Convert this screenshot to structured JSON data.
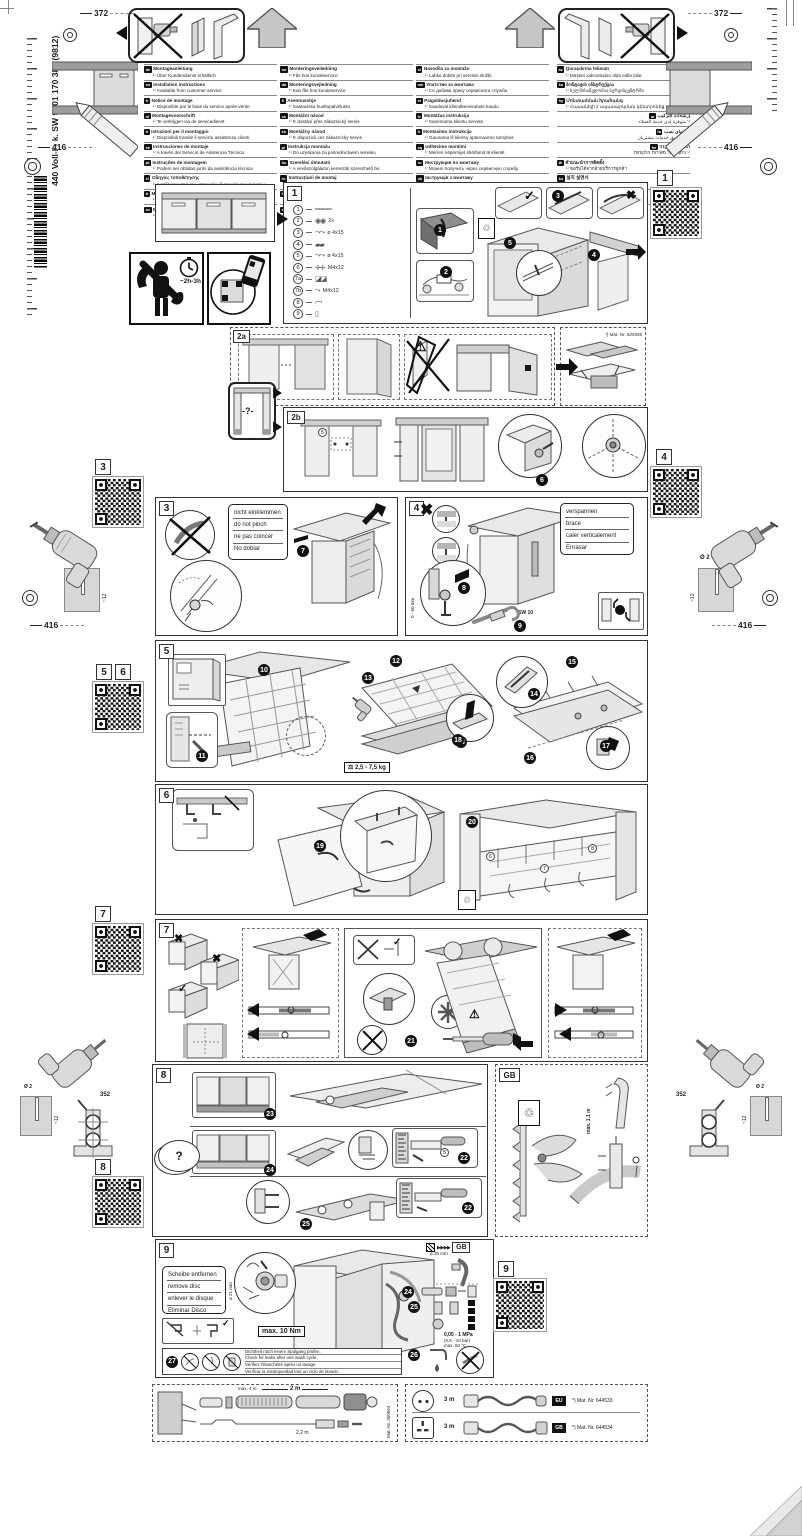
{
  "pg": {
    "vertical_code": "440 Voll-I - k. SW  9001 170 388 (9812)",
    "d372": "372",
    "d416": "416",
    "d352": "352",
    "drill_dia": "Ø 2",
    "drill_depth": "~12",
    "time_badge": "~2h-3h"
  },
  "ic": {
    "check": "✓",
    "cross": "✖",
    "warn": "⚠",
    "question": "?",
    "fast": "▶▶▶▶",
    "bin": "♲",
    "rotate": "↻"
  },
  "lang": {
    "col1": [
      {
        "code": "de",
        "title": "Montageanleitung",
        "note": "¹⁾ Über Kundendienst erhältlich"
      },
      {
        "code": "en",
        "title": "Installation instructions",
        "note": "¹⁾ Available from customer service"
      },
      {
        "code": "fr",
        "title": "Notice de montage",
        "note": "¹⁾ Disponible par le biais du service après-vente"
      },
      {
        "code": "nl",
        "title": "Montagevoorschrift",
        "note": "¹⁾ Te verkrijgen via de servicedienst"
      },
      {
        "code": "it",
        "title": "Istruzioni per il montaggio",
        "note": "¹⁾ Disponibili tramite il servizio assistenza clienti"
      },
      {
        "code": "es",
        "title": "Instrucciones de montaje",
        "note": "¹⁾ A través del Servicio de Asistencia Técnica"
      },
      {
        "code": "pt",
        "title": "Instruções de montagem",
        "note": "¹⁾ Podem ser obtidas junto da assistência técnica"
      },
      {
        "code": "el",
        "title": "Οδηγίες τοποθέτησης",
        "note": "¹⁾ Διατίθενται από την υπηρεσία εξυπηρέτησης πελατών"
      },
      {
        "code": "tr",
        "title": "Montaj kılavuzu",
        "note": "¹⁾ Yetkili servisten temin edilebilir"
      },
      {
        "code": "sv",
        "title": "Monteringsanvisning",
        "note": "¹⁾ Kan beställas via kundtjänst"
      }
    ],
    "col2": [
      {
        "code": "no",
        "title": "Monteringsveiledning",
        "note": "¹⁾ Fås hos kundeservice"
      },
      {
        "code": "da",
        "title": "Monteringsvejledning",
        "note": "¹⁾ Kan fås hos kundeservice"
      },
      {
        "code": "fi",
        "title": "Asennusohje",
        "note": "¹⁾ Saatavissa huoltopalvelusta"
      },
      {
        "code": "cs",
        "title": "Montážní návod",
        "note": "¹⁾ K dostání přes zákaznický servis"
      },
      {
        "code": "sk",
        "title": "Montážny návod",
        "note": "¹⁾ K dispozícii cez zákaznícky servis"
      },
      {
        "code": "pl",
        "title": "Instrukcja montażu",
        "note": "¹⁾ Do uzyskania za pośrednictwem serwisu"
      },
      {
        "code": "hu",
        "title": "Szerelési útmutató",
        "note": "¹⁾ A vevőszolgálaton keresztül szerezhető be"
      },
      {
        "code": "ro",
        "title": "Instrucţiuni de montaj",
        "note": "¹⁾ Se obţin prin intermediul unităţilor service"
      },
      {
        "code": "hr",
        "title": "Upute za montažu",
        "note": "¹⁾ Mogu se dobiti kod službe za korisnike"
      },
      {
        "code": "sr",
        "title": "Uputstvo za montažu",
        "note": "¹⁾ Može se nabaviti preko servisne službe"
      }
    ],
    "col3": [
      {
        "code": "sl",
        "title": "Navodila za montažo",
        "note": "¹⁾ Lahko dobite pri servisni službi"
      },
      {
        "code": "mk",
        "title": "Упатство за монтажа",
        "note": "¹⁾ Се добива преку сервисната служба"
      },
      {
        "code": "et",
        "title": "Paigaldusjuhend",
        "note": "¹⁾ Saadaval klienditeeninduse kaudu"
      },
      {
        "code": "lv",
        "title": "Montāžas instrukcija",
        "note": "¹⁾ Saņemama klientu servisā"
      },
      {
        "code": "lt",
        "title": "Montavimo instrukcija",
        "note": "¹⁾ Gaunama iš klientų aptarnavimo tarnybos"
      },
      {
        "code": "sq",
        "title": "Udhëzime montimi",
        "note": "¹⁾ Merren nëpërmjet shërbimit të klientit"
      },
      {
        "code": "ru",
        "title": "Инструкция по монтажу",
        "note": "¹⁾ Можно получить через сервисную службу"
      },
      {
        "code": "uk",
        "title": "Інструкція з монтажу",
        "note": "¹⁾ Можна отримати через сервісну службу"
      },
      {
        "code": "kk",
        "title": "Құрастыру нұсқаулығы",
        "note": "¹⁾ Сервистік қызметтен алуға болады"
      },
      {
        "code": "bg",
        "title": "Указание за монтаж",
        "note": "¹⁾ Получава се чрез сервизния отдел"
      }
    ],
    "col4": [
      {
        "code": "az",
        "title": "Quraşdırma təlimatı",
        "note": "¹⁾ Müştəri xidmətindən əldə edilə bilər"
      },
      {
        "code": "ka",
        "title": "მონტაჟის ინსტრუქცია",
        "note": "¹⁾ ხელმისაწვდომია სერვისცენტრში"
      },
      {
        "code": "hy",
        "title": "Մոնտաժման հրահանգ",
        "note": "¹⁾ Հասանելի է սպասարկման կենտրոնից"
      },
      {
        "code": "ar",
        "title": "إرشادات التركيب",
        "note": "¹⁾ متوفرة لدى خدمة العملاء",
        "rtl": true
      },
      {
        "code": "fa",
        "title": "راهنمای نصب",
        "note": "¹⁾ از طریق خدمات مشتریان",
        "rtl": true
      },
      {
        "code": "he",
        "title": "הוראות התקנה",
        "note": "¹⁾ ניתן לקבל משירות הלקוחות",
        "rtl": true
      },
      {
        "code": "th",
        "title": "คำแนะนำการติดตั้ง",
        "note": "¹⁾ ขอรับได้จากฝ่ายบริการลูกค้า"
      },
      {
        "code": "ko",
        "title": "설치 설명서",
        "note": "¹⁾ 고객 서비스 센터에서 제공"
      },
      {
        "code": "zh",
        "title": "安裝說明",
        "note": "¹⁾ 可向客戶服務中心索取"
      },
      {
        "code": "zh",
        "title": "安装说明",
        "note": "¹⁾ 可向客户服务中心索取"
      }
    ]
  },
  "s1": {
    "label": "1",
    "parts": [
      {
        "num": "1",
        "glyph": "════",
        "spec": ""
      },
      {
        "num": "2",
        "glyph": "◉◉",
        "spec": "2x"
      },
      {
        "num": "3",
        "glyph": "⤳⤳",
        "spec": "ø 4x15"
      },
      {
        "num": "4",
        "glyph": "▰▰",
        "spec": ""
      },
      {
        "num": "5",
        "glyph": "⤳⤳",
        "spec": "ø 4x15"
      },
      {
        "num": "6",
        "glyph": "✛✛",
        "spec": "M4x12"
      },
      {
        "num": "7a",
        "glyph": "◪◪",
        "spec": ""
      },
      {
        "num": "7b",
        "glyph": "⤳",
        "spec": "M4x12"
      },
      {
        "num": "8",
        "glyph": "⌐¬",
        "spec": ""
      },
      {
        "num": "9",
        "glyph": "▯",
        "spec": ""
      }
    ],
    "steps": [
      "1",
      "2",
      "3",
      "4",
      "5"
    ]
  },
  "s2a": {
    "label": "2a",
    "mat": "*) Mat.-Nr. 625456"
  },
  "s2b": {
    "label": "2b",
    "steps": [
      "6"
    ],
    "ref": "5"
  },
  "unknown_box": {
    "text": "-?-"
  },
  "s3": {
    "label": "3",
    "steps": [
      "7"
    ],
    "note": [
      "nicht einklemmen",
      "do not pinch",
      "ne pas coincer",
      "No doblar"
    ]
  },
  "s4": {
    "label": "4",
    "steps": [
      "8",
      "9"
    ],
    "note": [
      "verspannen",
      "brace",
      "caler verticalement",
      "Enrasar"
    ],
    "dim": "0 - 60 mm",
    "sw1": "SW 13",
    "sw2": "SW 10"
  },
  "s5": {
    "label": "5",
    "qr_labels": [
      "5",
      "6"
    ],
    "weight": "2,5 - 7,5 kg",
    "steps": [
      "10",
      "11",
      "12",
      "13",
      "14",
      "15",
      "16",
      "17",
      "18"
    ]
  },
  "s6": {
    "label": "6",
    "steps": [
      "19",
      "20"
    ],
    "refs": [
      "6",
      "7",
      "8"
    ]
  },
  "s7": {
    "label": "7",
    "steps": [
      "21"
    ]
  },
  "s8": {
    "label": "8",
    "steps": [
      "22",
      "23",
      "24",
      "25"
    ],
    "ref": "5",
    "bubble": "?",
    "gb": "GB",
    "gb_dim": "max. 1,1 m"
  },
  "s9": {
    "label": "9",
    "steps": [
      "24",
      "25",
      "26",
      "27"
    ],
    "disc_note": [
      "Scheibe entfernen",
      "remove disc",
      "enlever le disque",
      "Eliminar Disco"
    ],
    "torque": "max. 10 Nm",
    "torque_small": "10 Nm",
    "dia": "ø 21 mm",
    "hose_dia": "ø 35 mm",
    "gb": "GB",
    "pressure": [
      "0,05 - 1 MPa",
      "(0,5 - 10 bar)",
      "max. 60 °C"
    ],
    "leak_note": [
      "Dichtheit nach einem Spülgang prüfen.",
      "Check for leaks after one wash cycle.",
      "Vérifiez l'étanchéité après un lavage.",
      "Verificar la estanqueidad tras un ciclo de lavado."
    ]
  },
  "bt": {
    "left": {
      "max": "max. 4 m",
      "len1": "2 m",
      "len2": "2,2 m",
      "mat": "Mat.-Nr. 350564"
    },
    "right": [
      {
        "len": "3 m",
        "badge": "EU",
        "mat": "*) Mat. Nr. 644533"
      },
      {
        "len": "3 m",
        "badge": "GB",
        "mat": "*) Mat. Nr. 644534"
      }
    ]
  },
  "qr_labels": {
    "q1": "1",
    "q3": "3",
    "q4": "4",
    "q5": "5",
    "q6": "6",
    "q7": "7",
    "q8": "8",
    "q9": "9"
  }
}
